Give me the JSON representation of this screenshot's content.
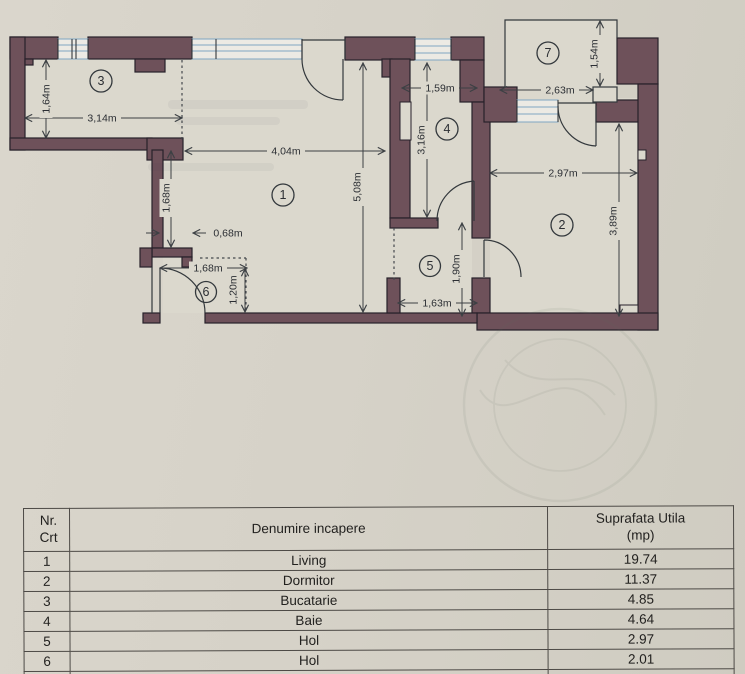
{
  "plan": {
    "rooms": {
      "r1": "1",
      "r2": "2",
      "r3": "3",
      "r4": "4",
      "r5": "5",
      "r6": "6",
      "r7": "7"
    },
    "dims": {
      "d1": "1,64m",
      "d2": "3,14m",
      "d3": "4,04m",
      "d4": "1,68m",
      "d5": "0,68m",
      "d6": "1,68m",
      "d7": "1,20m",
      "d8": "5,08m",
      "d9": "1,59m",
      "d10": "3,16m",
      "d11": "1,63m",
      "d12": "1,90m",
      "d13": "2,63m",
      "d14": "1,54m",
      "d15": "2,97m",
      "d16": "3,89m"
    }
  },
  "table": {
    "header": {
      "col1_line1": "Nr.",
      "col1_line2": "Crt",
      "col2": "Denumire incapere",
      "col3_line1": "Suprafata Utila",
      "col3_line2": "(mp)"
    },
    "rows": [
      {
        "nr": "1",
        "name": "Living",
        "area": "19.74"
      },
      {
        "nr": "2",
        "name": "Dormitor",
        "area": "11.37"
      },
      {
        "nr": "3",
        "name": "Bucatarie",
        "area": "4.85"
      },
      {
        "nr": "4",
        "name": "Baie",
        "area": "4.64"
      },
      {
        "nr": "5",
        "name": "Hol",
        "area": "2.97"
      },
      {
        "nr": "6",
        "name": "Hol",
        "area": "2.01"
      }
    ]
  },
  "colors": {
    "wall": "#6e515a",
    "window_blue": "#7fa6c2",
    "paper": "#d6d2c8",
    "room_fill": "#dbd8cd",
    "line": "#3c4044"
  }
}
